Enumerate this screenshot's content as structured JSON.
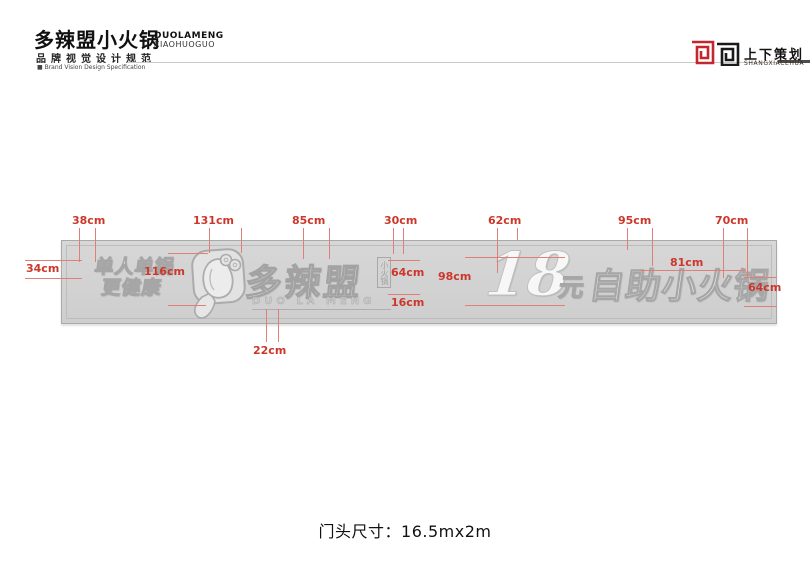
{
  "header": {
    "brand_cn": "多辣盟小火锅",
    "brand_en1": "DUOLAMENG",
    "brand_en2": "XIAOHUOGUO",
    "subtitle_cn": "品牌视觉设计规范",
    "subtitle_en": "■ Brand Vision Design Specification",
    "agency_cn": "上下策划",
    "agency_en": "SHANGXIACEHUA"
  },
  "sign": {
    "slogan_line1": "单人单锅",
    "slogan_line2": "更健康",
    "logo_cn": "多辣盟",
    "logo_seal": "小火锅",
    "logo_en": "DUO LA MENG",
    "price_number": "18",
    "price_unit": "元",
    "price_text": "自助小火锅"
  },
  "measurements": {
    "t38": "38cm",
    "t131": "131cm",
    "t85": "85cm",
    "t30": "30cm",
    "t62": "62cm",
    "t95": "95cm",
    "t70": "70cm",
    "l34": "34cm",
    "l116": "116cm",
    "m64a": "64cm",
    "m16": "16cm",
    "m98": "98cm",
    "m81": "81cm",
    "m64b": "64cm",
    "b22": "22cm"
  },
  "footer": {
    "door_size": "门头尺寸：16.5mx2m"
  },
  "colors": {
    "annotation_red": "#cc372b",
    "line_red": "#de8078",
    "agency_red": "#c1272d",
    "sign_background": "#d2d2d2"
  }
}
